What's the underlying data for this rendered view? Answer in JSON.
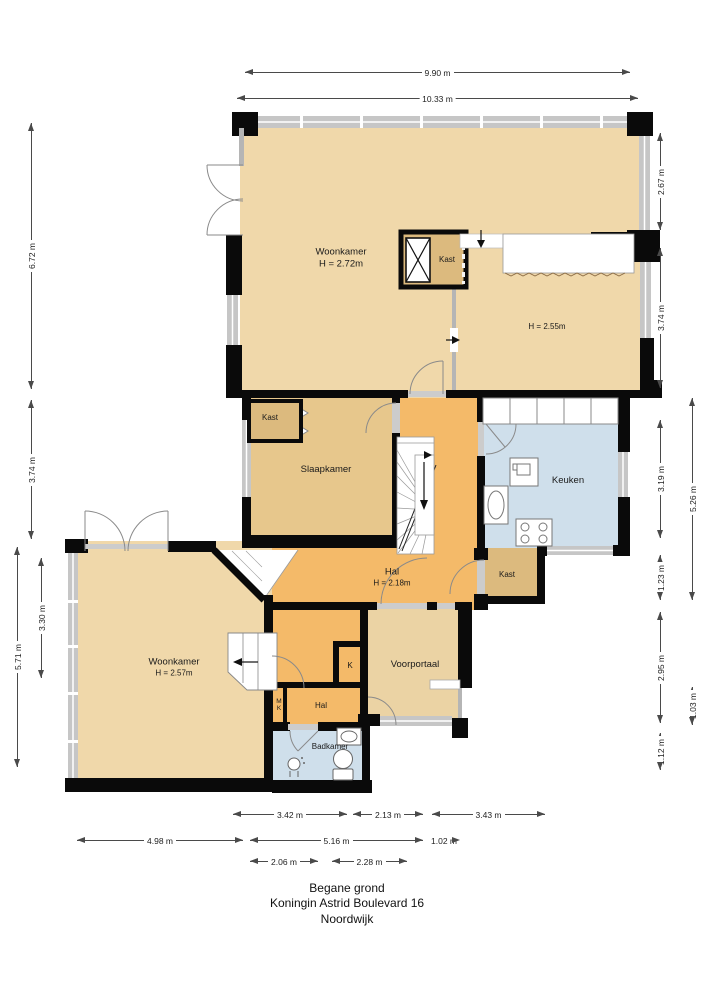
{
  "footer": {
    "line1": "Begane grond",
    "line2": "Koningin Astrid Boulevard 16",
    "line3": "Noordwijk"
  },
  "rooms": {
    "woonkamer_top": {
      "name": "Woonkamer",
      "height": "H = 2.72m"
    },
    "kast_top": {
      "name": "Kast"
    },
    "room_right": {
      "height": "H = 2.55m"
    },
    "slaapkamer": {
      "name": "Slaapkamer"
    },
    "kast_slaapkamer": {
      "name": "Kast"
    },
    "keuken": {
      "name": "Keuken"
    },
    "hal": {
      "name": "Hal",
      "height": "H = 2.18m"
    },
    "kast_mid": {
      "name": "Kast"
    },
    "voorportaal": {
      "name": "Voorportaal"
    },
    "woonkamer_bottom": {
      "name": "Woonkamer",
      "height": "H = 2.57m"
    },
    "k": {
      "name": "K"
    },
    "mk": {
      "name": "MK"
    },
    "hal_small": {
      "name": "Hal"
    },
    "badkamer": {
      "name": "Badkamer"
    }
  },
  "dims": {
    "top": [
      "9.90 m",
      "10.33 m"
    ],
    "left": [
      "6.72 m",
      "3.74 m",
      "3.30 m",
      "5.71 m"
    ],
    "right": [
      "2.67 m",
      "3.74 m",
      "3.19 m",
      "1.23 m",
      "2.95 m",
      "1.12 m",
      "5.26 m",
      "1.03 m"
    ],
    "bottom": [
      "3.42 m",
      "2.13 m",
      "3.43 m",
      "4.98 m",
      "5.16 m",
      "1.02 m",
      "2.06 m",
      "2.28 m"
    ]
  },
  "colors": {
    "room_tan": "#f0d8aa",
    "room_honey": "#e7c78c",
    "closet_tan": "#dcba7e",
    "hall_orange": "#f4ba69",
    "portal_tan": "#ebd3a4",
    "wet_room_blue": "#cfdfeb",
    "wall_black": "#0a0a0a",
    "window_gray": "#c6c6c6"
  }
}
